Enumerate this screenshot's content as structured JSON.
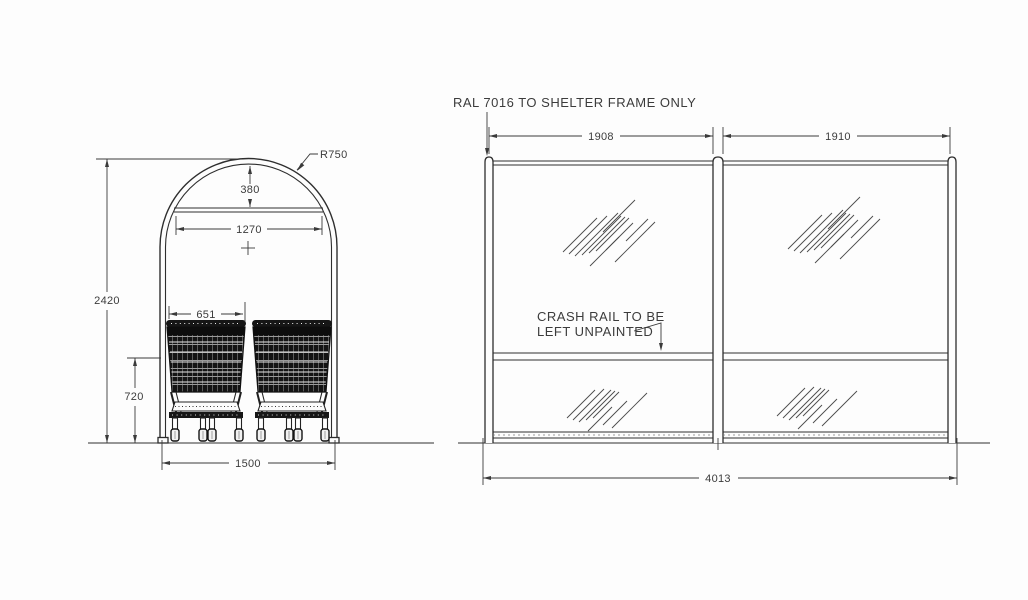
{
  "colors": {
    "background": "#fdfdfd",
    "line": "#2e2e2e",
    "dimension": "#3a3a3a",
    "text": "#3c3c3c"
  },
  "end_view": {
    "radius_label": "R750",
    "dim_apex_to_bar": "380",
    "dim_bar_width": "1270",
    "dim_overall_height": "2420",
    "dim_trolley_width": "651",
    "dim_crash_rail_height": "720",
    "dim_overall_width": "1500"
  },
  "side_view": {
    "frame_note": "RAL 7016 TO SHELTER FRAME ONLY",
    "crash_rail_note_line1": "CRASH RAIL TO BE",
    "crash_rail_note_line2": "LEFT UNPAINTED",
    "dim_bay_left": "1908",
    "dim_bay_right": "1910",
    "dim_overall_width": "4013"
  }
}
